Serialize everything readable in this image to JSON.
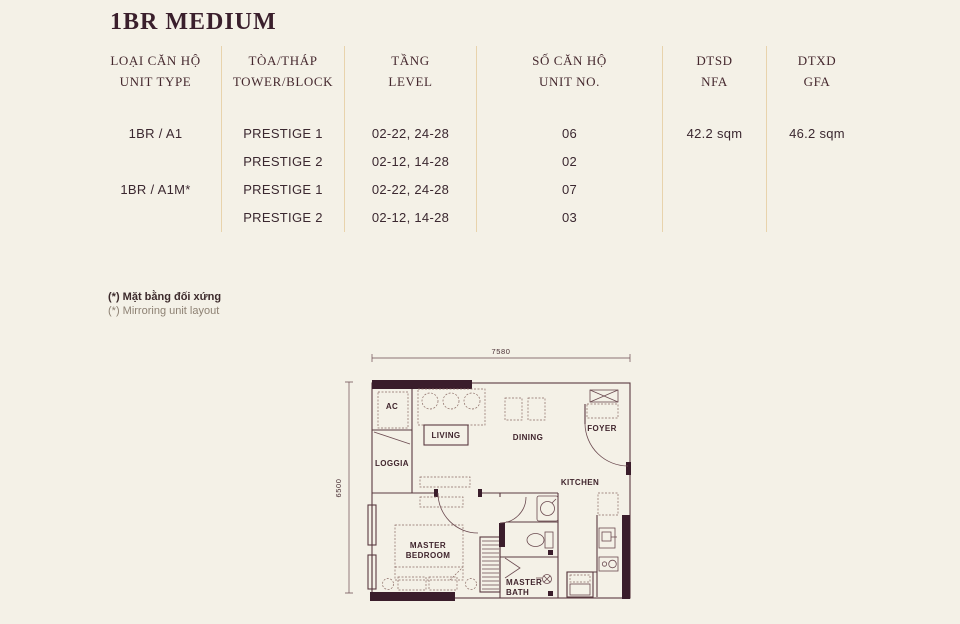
{
  "title": "1BR MEDIUM",
  "table": {
    "headers": [
      {
        "vi": "LOẠI CĂN HỘ",
        "en": "UNIT TYPE"
      },
      {
        "vi": "TÒA/THÁP",
        "en": "TOWER/BLOCK"
      },
      {
        "vi": "TẦNG",
        "en": "LEVEL"
      },
      {
        "vi": "SỐ CĂN HỘ",
        "en": "UNIT NO."
      },
      {
        "vi": "DTSD",
        "en": "NFA"
      },
      {
        "vi": "DTXD",
        "en": "GFA"
      }
    ],
    "rows": [
      {
        "unit_type": "1BR / A1",
        "tower": "PRESTIGE 1",
        "level": "02-22, 24-28",
        "unit_no": "06",
        "nfa": "42.2 sqm",
        "gfa": "46.2 sqm"
      },
      {
        "unit_type": "",
        "tower": "PRESTIGE 2",
        "level": "02-12, 14-28",
        "unit_no": "02",
        "nfa": "",
        "gfa": ""
      },
      {
        "unit_type": "1BR / A1M*",
        "tower": "PRESTIGE 1",
        "level": "02-22, 24-28",
        "unit_no": "07",
        "nfa": "",
        "gfa": ""
      },
      {
        "unit_type": "",
        "tower": "PRESTIGE 2",
        "level": "02-12, 14-28",
        "unit_no": "03",
        "nfa": "",
        "gfa": ""
      }
    ]
  },
  "footnote": {
    "vi": "(*) Mặt bằng đối xứng",
    "en": "(*) Mirroring unit layout"
  },
  "floorplan": {
    "dim_width": "7580",
    "dim_height": "6500",
    "labels": {
      "ac": "AC",
      "loggia": "LOGGIA",
      "living": "LIVING",
      "dining": "DINING",
      "foyer": "FOYER",
      "kitchen": "KITCHEN",
      "bedroom1": "MASTER",
      "bedroom2": "BEDROOM",
      "bath1": "MASTER",
      "bath2": "BATH"
    }
  },
  "colors": {
    "background": "#f4f1e7",
    "text": "#42262e",
    "divider": "#e8d3ac",
    "wall": "#5a3b41",
    "wall_dark": "#3a1d2b"
  }
}
